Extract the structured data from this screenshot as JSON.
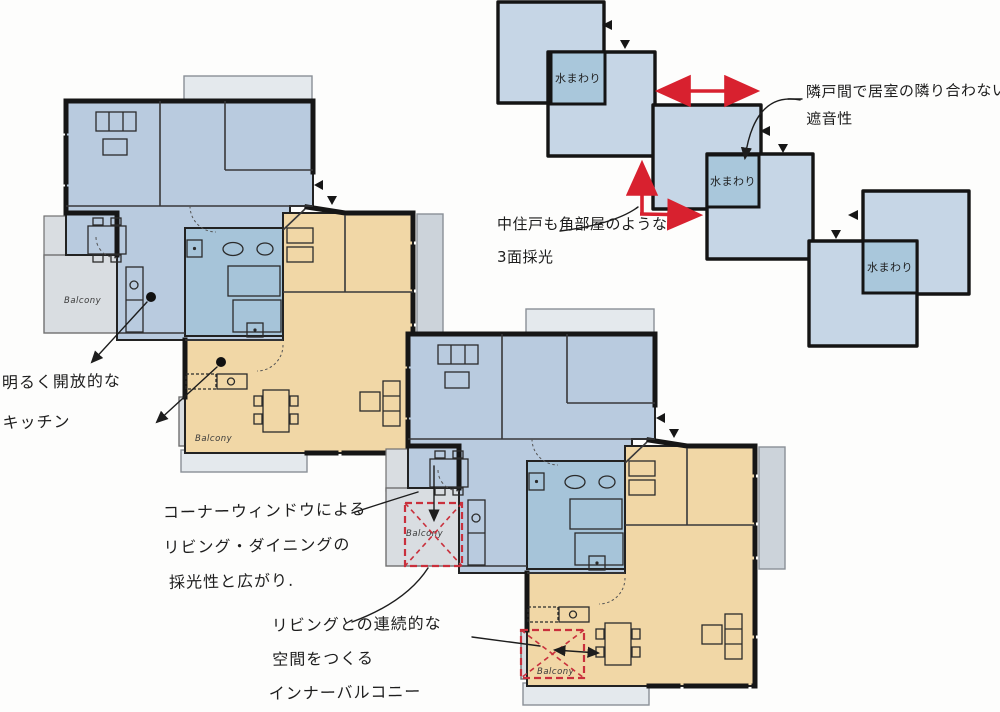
{
  "title": "apartment-plan-sketch",
  "labels": {
    "water_area": "水まわり",
    "balcony": "Balcony"
  },
  "notes": {
    "soundproof": [
      "隣戸間で居室の隣り合わない",
      "遮音性"
    ],
    "daylight": [
      "中住戸も角部屋のような",
      "3面採光"
    ],
    "kitchen": [
      "明るく開放的な",
      "キッチン"
    ],
    "corner_window": [
      "コーナーウィンドウによる",
      "リビング・ダイニングの",
      "採光性と広がり."
    ],
    "inner_balcony": [
      "リビングとの連続的な",
      "空間をつくる",
      "インナーバルコニー"
    ]
  },
  "colors": {
    "room_blue": "#b9cbdf",
    "water_block_blue": "#a6c4d9",
    "room_orange": "#f1d7a6",
    "balcony_grey": "#d9dde1",
    "diagram_square_blue": "#c6d6e6",
    "diagram_water_blue": "#a9c7db",
    "arrow_red": "#d8212f",
    "wall_black": "#161616",
    "ink": "#1d1d1d"
  }
}
